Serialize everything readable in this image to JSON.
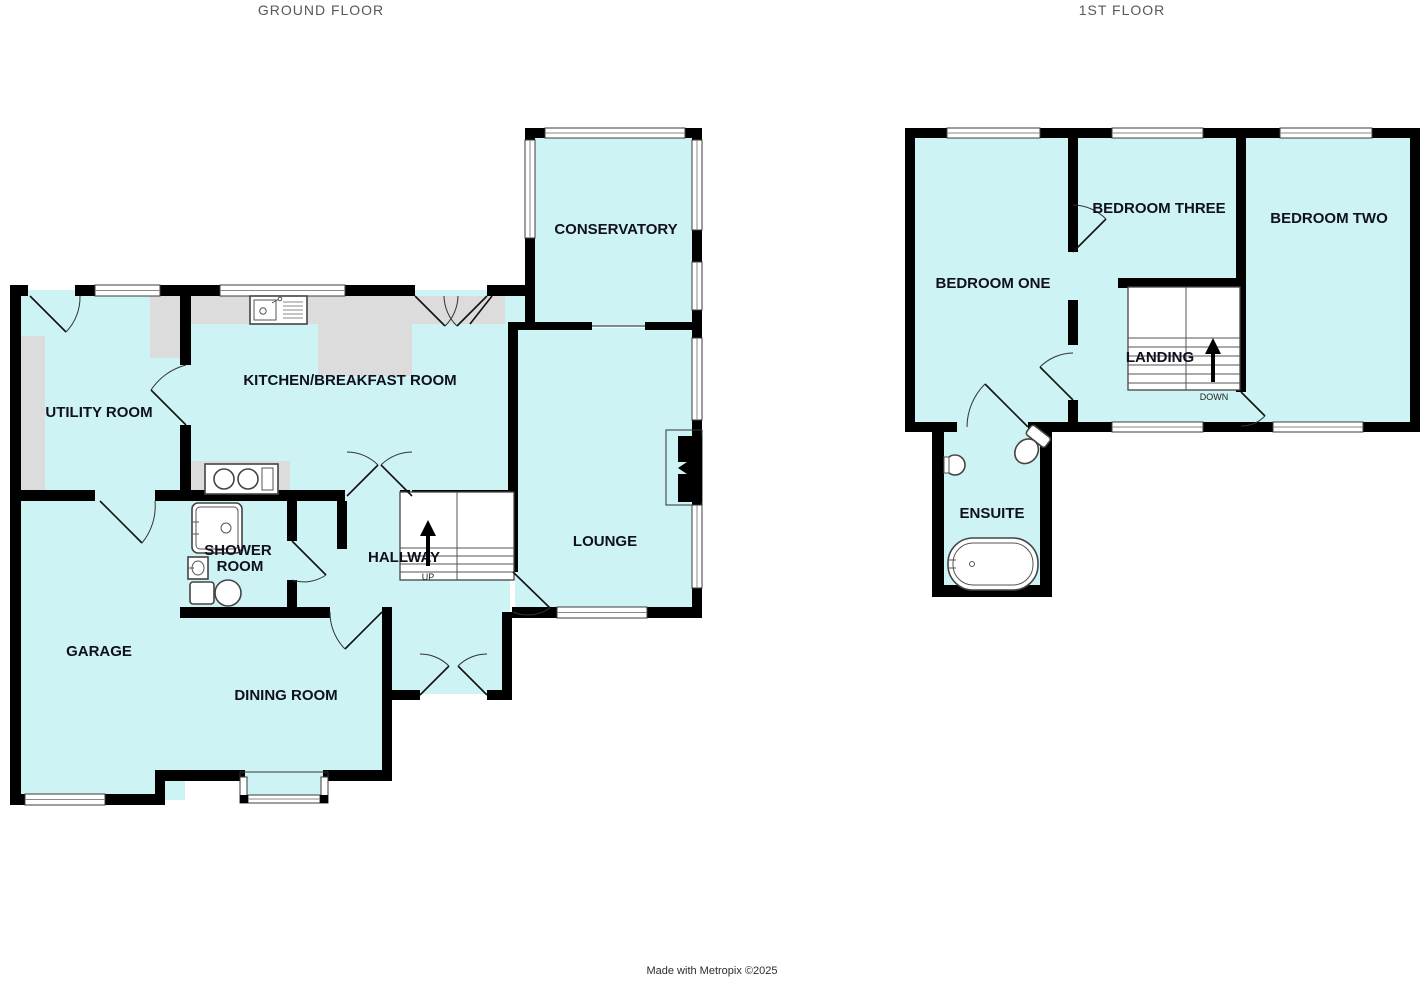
{
  "colors": {
    "room_fill": "#cdf3f5",
    "wall": "#000000",
    "counter": "#dcdcdc",
    "title": "#58585a",
    "label": "#10101e"
  },
  "ground_floor": {
    "title": "GROUND FLOOR",
    "rooms": [
      {
        "id": "conservatory",
        "label": "CONSERVATORY"
      },
      {
        "id": "kitchen-breakfast-room",
        "label": "KITCHEN/BREAKFAST ROOM"
      },
      {
        "id": "utility-room",
        "label": "UTILITY ROOM"
      },
      {
        "id": "lounge",
        "label": "LOUNGE"
      },
      {
        "id": "shower-room",
        "label": "SHOWER ROOM",
        "lines": [
          "SHOWER",
          "ROOM"
        ]
      },
      {
        "id": "hallway",
        "label": "HALLWAY"
      },
      {
        "id": "garage",
        "label": "GARAGE"
      },
      {
        "id": "dining-room",
        "label": "DINING ROOM"
      }
    ],
    "stairs_label": "UP"
  },
  "first_floor": {
    "title": "1ST FLOOR",
    "rooms": [
      {
        "id": "bedroom-one",
        "label": "BEDROOM ONE"
      },
      {
        "id": "bedroom-three",
        "label": "BEDROOM THREE"
      },
      {
        "id": "bedroom-two",
        "label": "BEDROOM TWO"
      },
      {
        "id": "landing",
        "label": "LANDING"
      },
      {
        "id": "ensuite",
        "label": "ENSUITE"
      }
    ],
    "stairs_label": "DOWN"
  },
  "footer": {
    "credit": "Made with Metropix ©2025"
  }
}
